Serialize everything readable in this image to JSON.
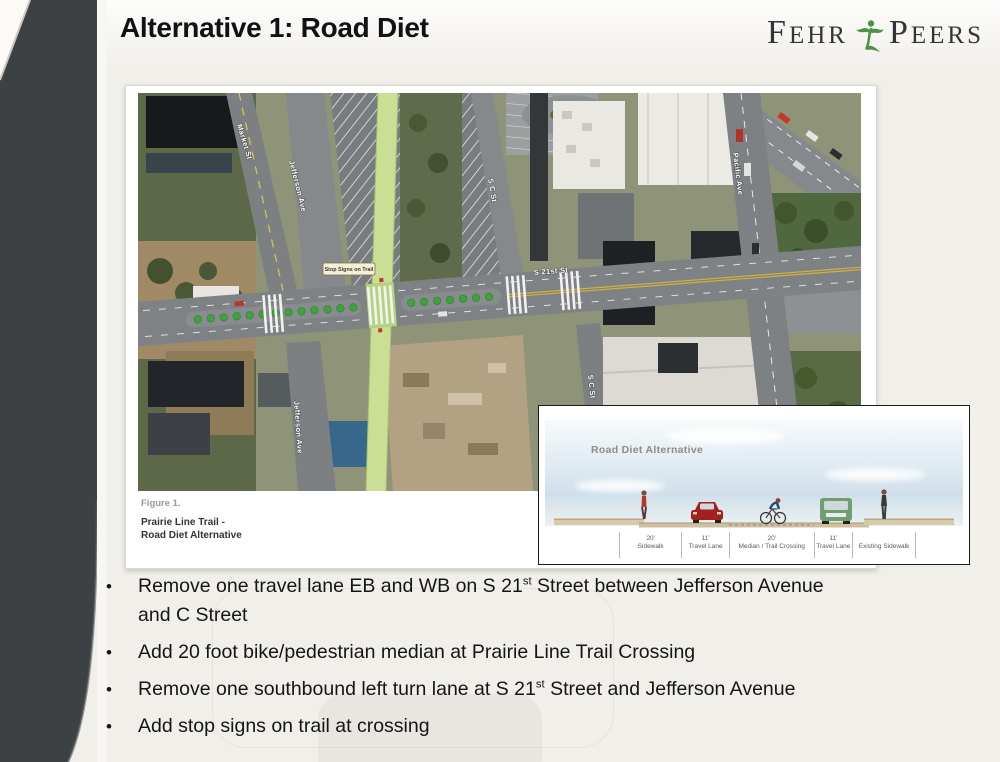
{
  "slide": {
    "title": "Alternative 1: Road Diet",
    "logo": {
      "word1": "FEHR",
      "word2": "PEERS",
      "icon": "fehr-peers-figure-icon",
      "green": "#4e9247",
      "text_color": "#343434"
    }
  },
  "map": {
    "caption_figure": "Figure 1.",
    "caption_line1": "Prairie Line Trail -",
    "caption_line2": "Road Diet Alternative",
    "labels": {
      "market": "Market St",
      "jefferson_upper": "Jefferson Ave",
      "jefferson_lower": "Jefferson Ave",
      "scst_upper": "S C St",
      "scst_lower": "S C St",
      "s21st": "S 21st St",
      "pacific": "Pacific Ave",
      "stop_signs": "Stop Signs on Trail"
    }
  },
  "inset": {
    "title": "Road Diet Alternative",
    "sections": [
      {
        "dim": "20'",
        "label": "Sidewalk"
      },
      {
        "dim": "11'",
        "label": "Travel Lane"
      },
      {
        "dim": "20'",
        "label": "Median / Trail Crossing"
      },
      {
        "dim": "11'",
        "label": "Travel Lane"
      },
      {
        "dim": "",
        "label": "Existing Sidewalk"
      }
    ]
  },
  "bullets": [
    [
      {
        "t": "Remove one travel lane EB and WB on S 21"
      },
      {
        "t": "st",
        "sup": true
      },
      {
        "t": " Street between Jefferson Avenue"
      },
      {
        "br": true
      },
      {
        "t": "and C Street"
      }
    ],
    [
      {
        "t": "Add 20 foot bike/pedestrian median at Prairie Line Trail Crossing"
      }
    ],
    [
      {
        "t": "Remove one southbound left turn lane at S 21"
      },
      {
        "t": "st",
        "sup": true
      },
      {
        "t": " Street and Jefferson Avenue"
      }
    ],
    [
      {
        "t": "Add stop signs on trail at crossing"
      }
    ]
  ],
  "colors": {
    "background": "#f1efea",
    "sidebar": "#3e4144",
    "trail_green": "#cade94",
    "median_dot_green": "#3fa23c",
    "logo_green": "#4e9247"
  }
}
